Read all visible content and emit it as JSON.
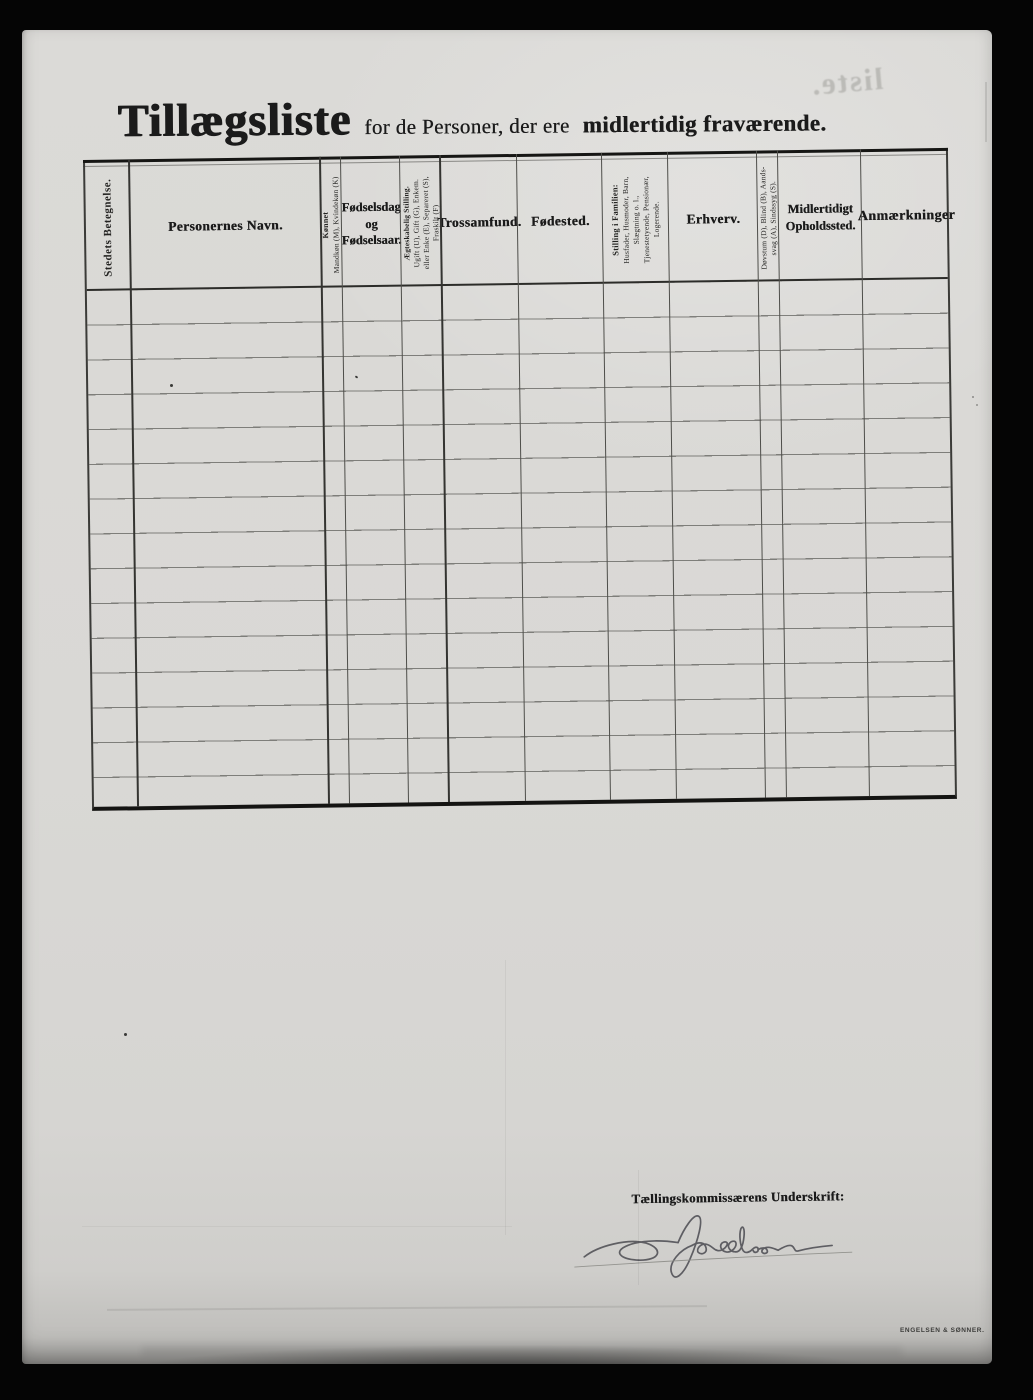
{
  "scan": {
    "title": {
      "main": "Tillægsliste",
      "mid": "for de Personer, der ere",
      "tail": "midlertidig fraværende."
    },
    "bleedthrough": {
      "mirrored_text": "liste."
    },
    "table": {
      "row_count": 15,
      "columns": [
        {
          "name": "stedets-betegnelse",
          "label": "Stedets Betegnelse."
        },
        {
          "name": "personernes-navn",
          "label": "Personernes Navn."
        },
        {
          "name": "konnet",
          "line1": "Kønnet",
          "line2": "Mandkøn (M), Kvindekøn (K)"
        },
        {
          "name": "fodselsdag-og-fodselsaar",
          "line1": "Fødselsdag",
          "line2": "og",
          "line3": "Fødselsaar."
        },
        {
          "name": "aegteskabelig-stilling",
          "line1": "Ægteskabelig Stilling.",
          "line2": "Ugift (U), Gift (G), Enkem.",
          "line3": "eller Enke (E), Separeret (S),",
          "line4": "Fraskilt (F)"
        },
        {
          "name": "trossamfund",
          "label": "Trossamfund."
        },
        {
          "name": "fodested",
          "label": "Fødested."
        },
        {
          "name": "stilling-i-familien",
          "line1": "Stilling i Familien:",
          "line2": "Husfader, Husmoder, Barn,",
          "line3": "Slægtning o. l.,",
          "line4": "Tjenestetyende, Pensionær,",
          "line5": "Logerende."
        },
        {
          "name": "erhverv",
          "label": "Erhverv."
        },
        {
          "name": "dovstum-blind",
          "line1": "Døvstum (D), Blind (B), Aands-",
          "line2": "svag (A), Sindssyg (S)."
        },
        {
          "name": "midlertidigt-opholdssted",
          "line1": "Midlertidigt",
          "line2": "Opholdssted."
        },
        {
          "name": "anmaerkninger",
          "label": "Anmærkninger"
        }
      ]
    },
    "footer": {
      "signature_label": "Tællingskommissærens Underskrift:",
      "signature_transcription": "A. Jacobsen",
      "printer_mark": "ENGELSEN & SØNNER."
    },
    "colors": {
      "paper": "#d9d8d5",
      "ink": "#1b1b1b",
      "background": "#050505"
    }
  }
}
